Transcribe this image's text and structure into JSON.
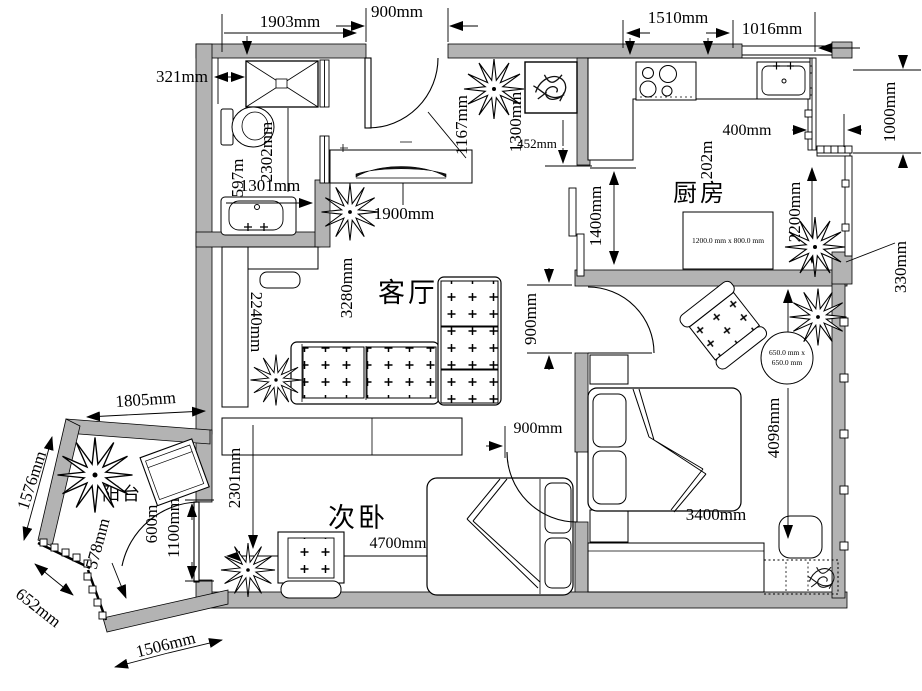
{
  "rooms": {
    "living": "客厅",
    "kitchen": "厨房",
    "second_bedroom": "次卧",
    "balcony": "阳台"
  },
  "furniture_labels": {
    "kitchen_table": "1200.0 mm x 800.0 mm",
    "round_table_line1": "650.0 mm x",
    "round_table_line2": "650.0 mm"
  },
  "dims": {
    "top_width": "1903mm",
    "entry_door": "900mm",
    "kitchen_top": "1510mm",
    "kitchen_right_top": "1016mm",
    "bath_wall_offset": "321mm",
    "toilet_depth": "597m",
    "bath_length": "2302mm",
    "vanity_width": "1301mm",
    "entry_swing": "1167mm",
    "hall_width": "1300mm",
    "hall_gap": "452mm",
    "kitchen_clear": "1400mm",
    "counter_depth": "202m",
    "bay_offset": "400mm",
    "bay_height": "1000mm",
    "kitchen_side": "2200mm",
    "bay_step": "330mm",
    "tv_width": "1900mm",
    "living_width": "3280mm",
    "cabinet_height": "2240mm",
    "master_door": "900mm",
    "bedroom2_door": "900mm",
    "master_length": "4098mm",
    "bed_width": "3400mm",
    "bedroom2_width": "4700mm",
    "bedroom2_depth": "2301mm",
    "balcony_top": "1805mm",
    "balcony_left": "1576mm",
    "balcony_corner": "652mm",
    "balcony_bottom": "1506mm",
    "balcony_window": "578mm",
    "washer_width": "600m",
    "balcony_door": "1100mm"
  },
  "colors": {
    "wall_fill": "#b3b3b3",
    "line": "#000000",
    "background": "#ffffff"
  }
}
